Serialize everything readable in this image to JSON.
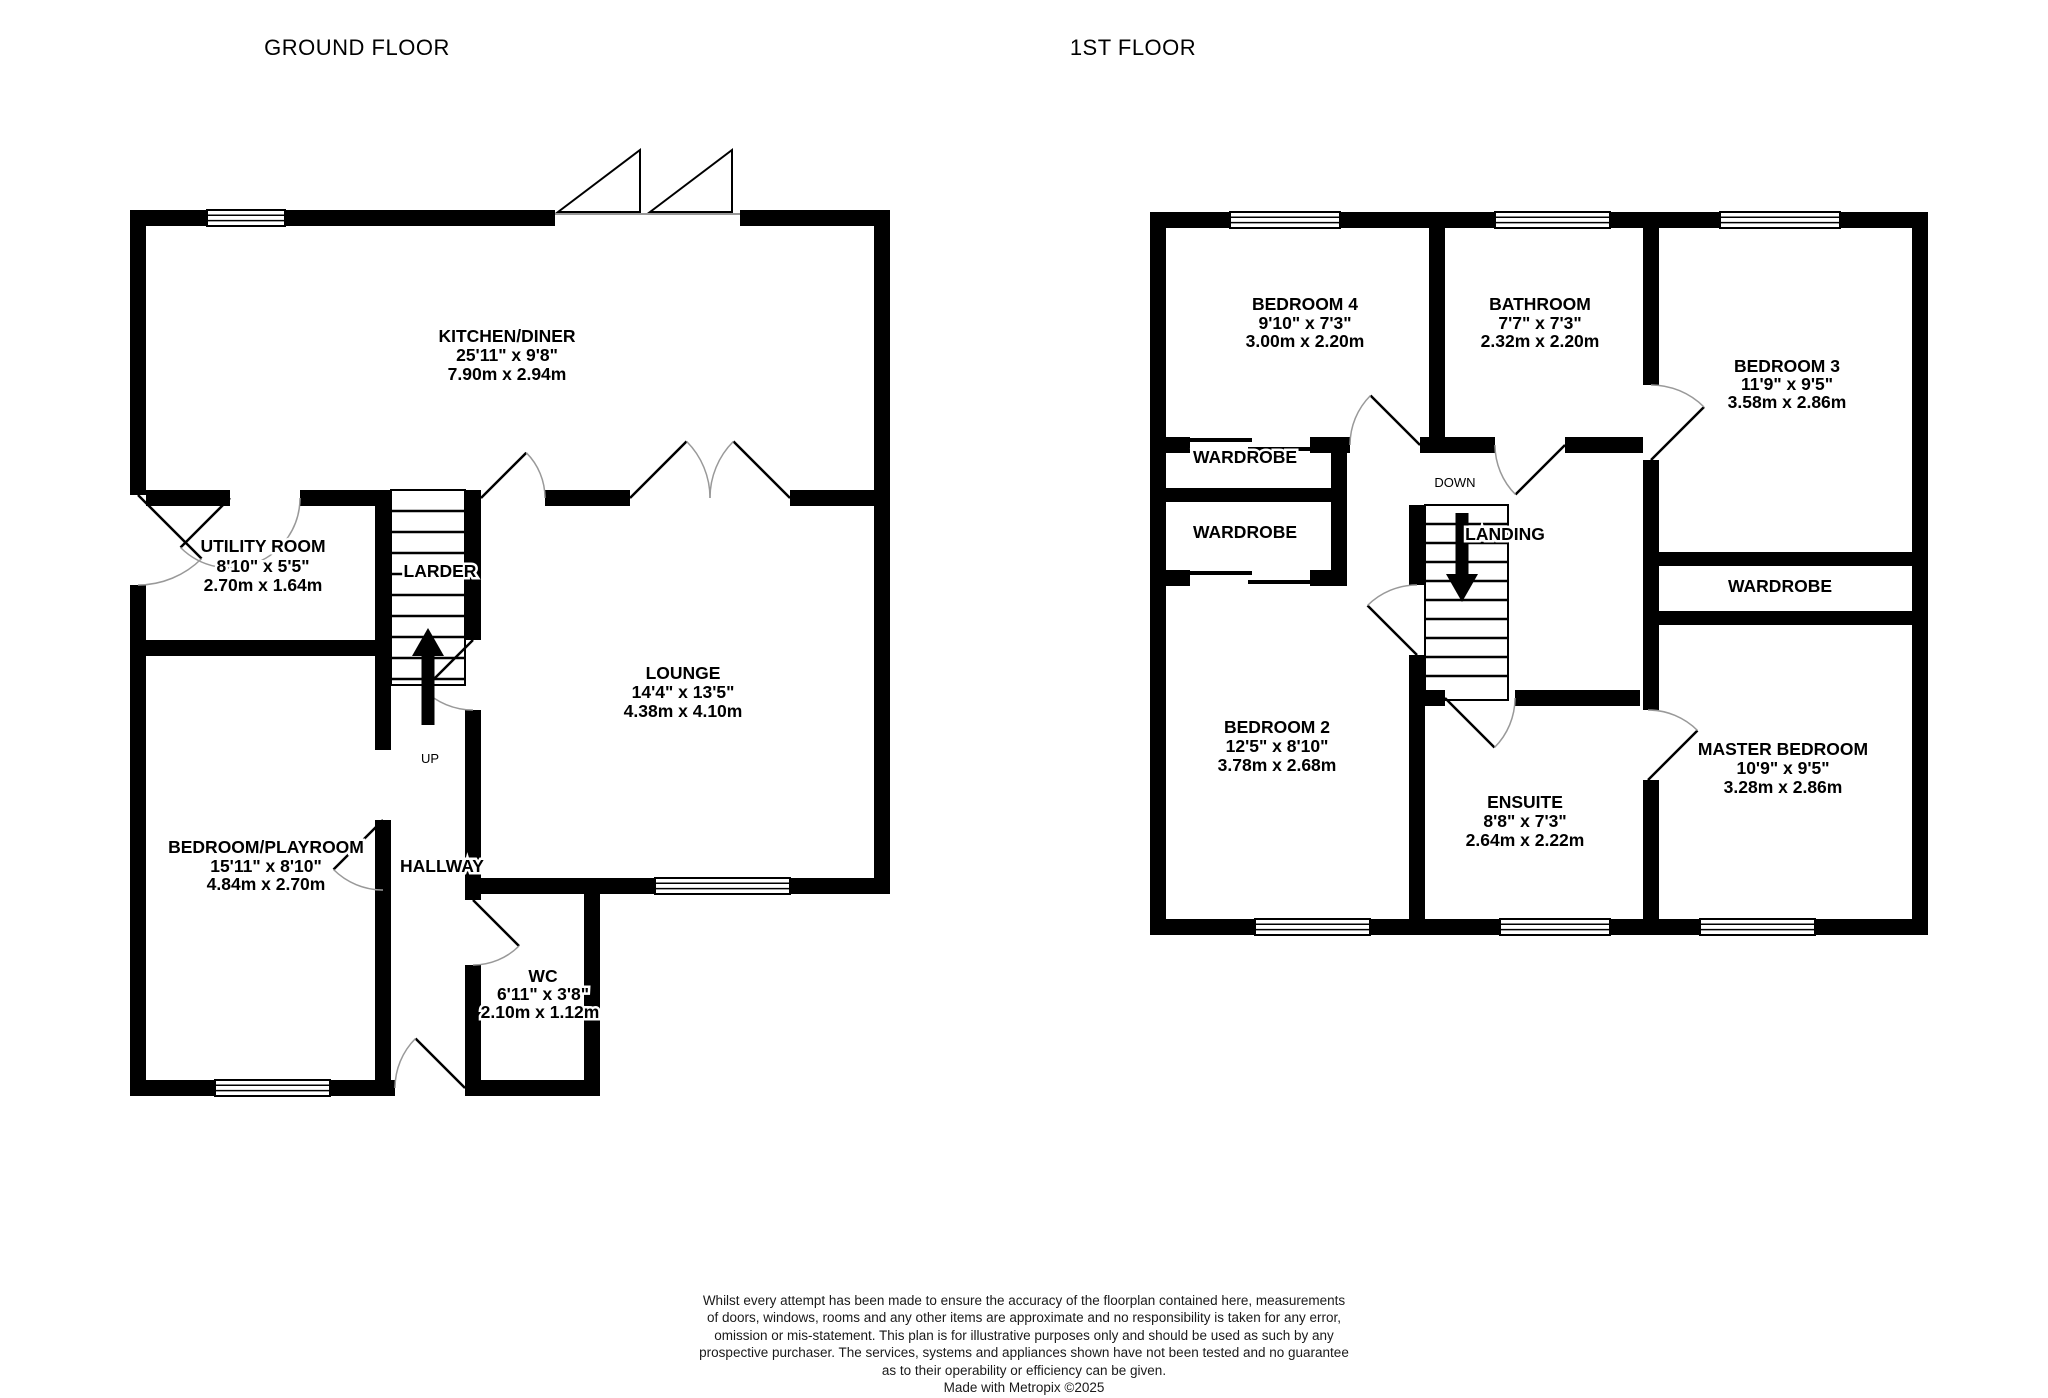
{
  "colors": {
    "wall": "#000000",
    "background": "#ffffff",
    "door_arc": "#999999"
  },
  "gf": {
    "title": "GROUND FLOOR",
    "kitchen": {
      "name": "KITCHEN/DINER",
      "imp": "25'11\"  x 9'8\"",
      "met": "7.90m  x 2.94m"
    },
    "utility": {
      "name": "UTILITY ROOM",
      "imp": "8'10\"  x 5'5\"",
      "met": "2.70m  x 1.64m"
    },
    "larder": {
      "name": "LARDER"
    },
    "lounge": {
      "name": "LOUNGE",
      "imp": "14'4\"  x 13'5\"",
      "met": "4.38m  x 4.10m"
    },
    "playroom": {
      "name": "BEDROOM/PLAYROOM",
      "imp": "15'11\"  x 8'10\"",
      "met": "4.84m  x 2.70m"
    },
    "hallway": {
      "name": "HALLWAY"
    },
    "wc": {
      "name": "WC",
      "imp": "6'11\"  x 3'8\"",
      "met": "2.10m  x 1.12m"
    },
    "up_label": "UP"
  },
  "ff": {
    "title": "1ST FLOOR",
    "bedroom4": {
      "name": "BEDROOM 4",
      "imp": "9'10\"  x 7'3\"",
      "met": "3.00m  x 2.20m"
    },
    "bathroom": {
      "name": "BATHROOM",
      "imp": "7'7\"  x 7'3\"",
      "met": "2.32m  x 2.20m"
    },
    "bedroom3": {
      "name": "BEDROOM 3",
      "imp": "11'9\"  x 9'5\"",
      "met": "3.58m  x 2.86m"
    },
    "wardrobe1": {
      "name": "WARDROBE"
    },
    "wardrobe2": {
      "name": "WARDROBE"
    },
    "wardrobe3": {
      "name": "WARDROBE"
    },
    "bedroom2": {
      "name": "BEDROOM 2",
      "imp": "12'5\"  x 8'10\"",
      "met": "3.78m  x 2.68m"
    },
    "ensuite": {
      "name": "ENSUITE",
      "imp": "8'8\"  x 7'3\"",
      "met": "2.64m  x 2.22m"
    },
    "master": {
      "name": "MASTER BEDROOM",
      "imp": "10'9\"  x 9'5\"",
      "met": "3.28m  x 2.86m"
    },
    "landing": {
      "name": "LANDING"
    },
    "down_label": "DOWN"
  },
  "footer": {
    "disclaimer": "Whilst every attempt has been made to ensure the accuracy of the floorplan contained here, measurements\nof doors, windows, rooms and any other items are approximate and no responsibility is taken for any error,\nomission or mis-statement. This plan is for illustrative purposes only and should be used as such by any\nprospective purchaser. The services, systems and appliances shown have not been tested and no guarantee\nas to their operability or efficiency can be given.\nMade with Metropix ©2025"
  }
}
